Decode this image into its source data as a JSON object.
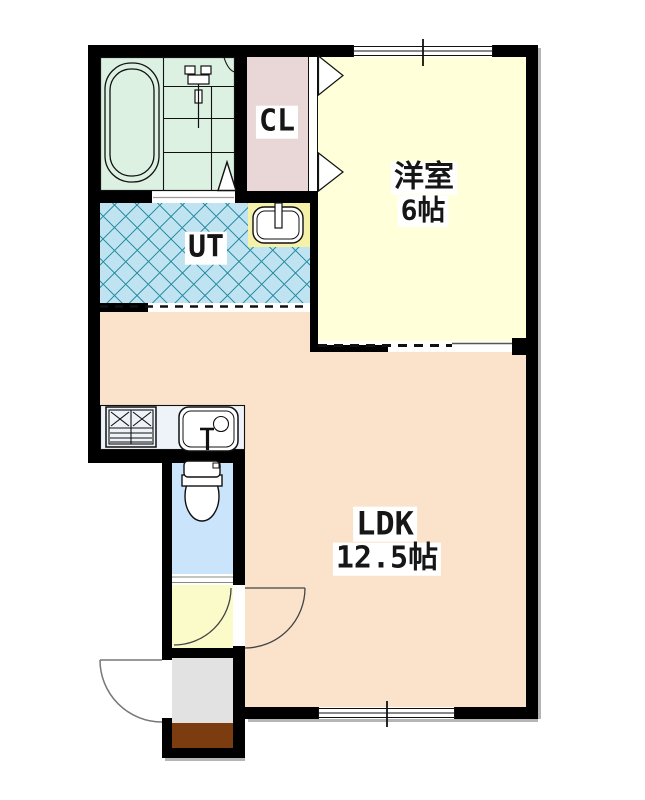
{
  "plan": {
    "type": "apartment-floor-plan",
    "rooms": {
      "western_room": {
        "name": "洋室",
        "size": "6帖",
        "color": "#ffffd9"
      },
      "ldk": {
        "name": "LDK",
        "size": "12.5帖",
        "color": "#fbe3cb"
      },
      "closet": {
        "label": "CL",
        "color": "#e9d7d8"
      },
      "utility": {
        "label": "UT",
        "color": "#bfe3f1",
        "hatch_color": "#288ca0"
      },
      "bathroom": {
        "color": "#ddf1e3"
      },
      "toilet": {
        "color": "#c9e4fb"
      },
      "washbasin_area": {
        "color": "#f6f1a8"
      },
      "storage": {
        "color": "#fbfbc9"
      },
      "entrance": {
        "color": "#e2e2e2"
      },
      "entrance_mat": {
        "color": "#7b3d10"
      },
      "kitchen_counter": {
        "color": "#edf3f8"
      }
    },
    "structure": {
      "wall_color": "#000000",
      "fixture_outline_color": "#111111",
      "door_arc_color": "#555555",
      "shadow_color": "#b5b5b5",
      "background": "#ffffff"
    },
    "icons": {
      "bathtub": "bathtub-icon",
      "shower_mixer": "shower-mixer-icon",
      "bath_door_marker": "door-pivot-triangle-icon",
      "folding_door": "folding-door-triangles-icon",
      "washbasin": "washbasin-icon",
      "stove": "stove-icon",
      "kitchen_sink": "kitchen-sink-icon",
      "toilet": "toilet-icon",
      "sliding_window": "sliding-window-icon",
      "hinged_door": "door-swing-arc-icon"
    }
  }
}
